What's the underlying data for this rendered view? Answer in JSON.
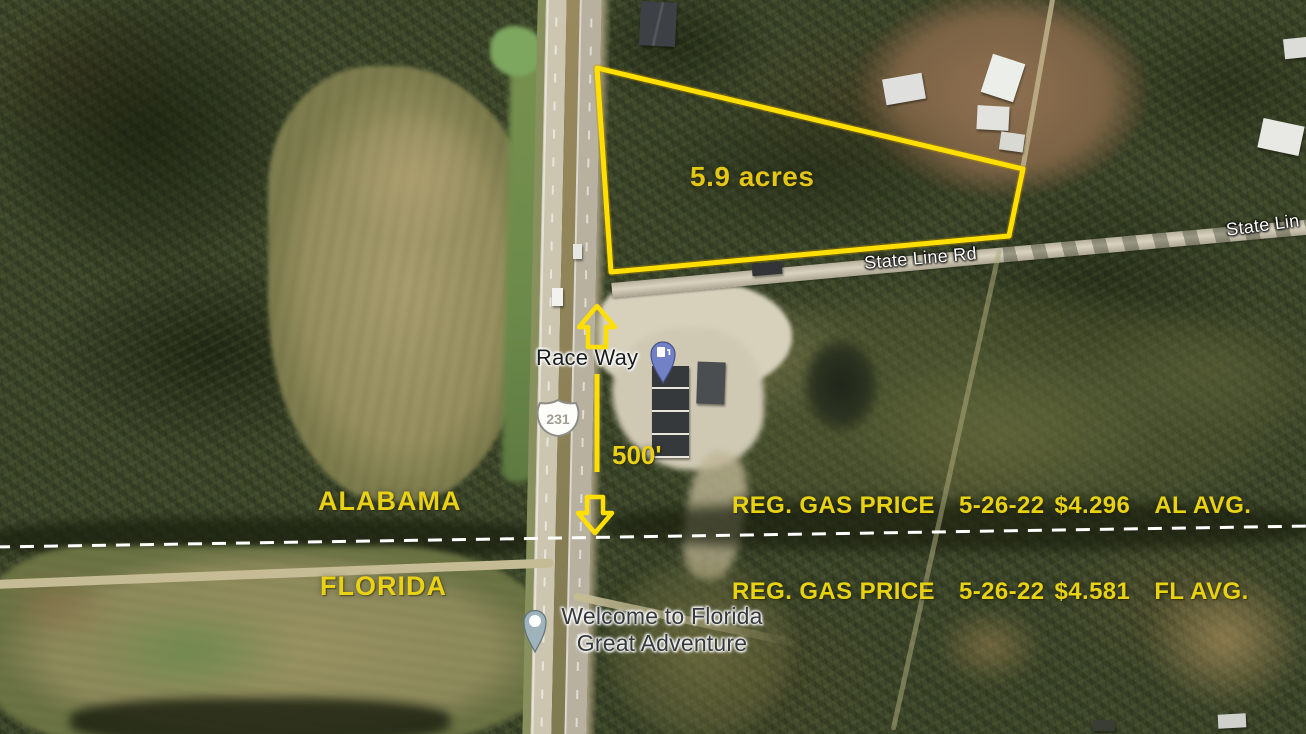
{
  "map": {
    "colors": {
      "annotation_yellow": "#e9d216",
      "boundary_yellow": "#ffdf00",
      "state_border_white": "#ffffff"
    },
    "parcel": {
      "acreage": "5.9 acres"
    },
    "measurement": {
      "distance": "500'"
    },
    "roads": {
      "state_line_rd_label": "State Line Rd",
      "state_line_rd_label_right": "State Lin",
      "us_route_shield": "231"
    },
    "places": {
      "gas_station": "Race Way",
      "welcome_sign_line1": "Welcome to Florida",
      "welcome_sign_line2": "Great Adventure"
    },
    "states": {
      "north": "ALABAMA",
      "south": "FLORIDA"
    },
    "gas_prices": [
      {
        "label": "REG. GAS PRICE",
        "date": "5-26-22",
        "price": "$4.296",
        "region": "AL AVG."
      },
      {
        "label": "REG. GAS PRICE",
        "date": "5-26-22",
        "price": "$4.581",
        "region": "FL AVG."
      }
    ]
  }
}
